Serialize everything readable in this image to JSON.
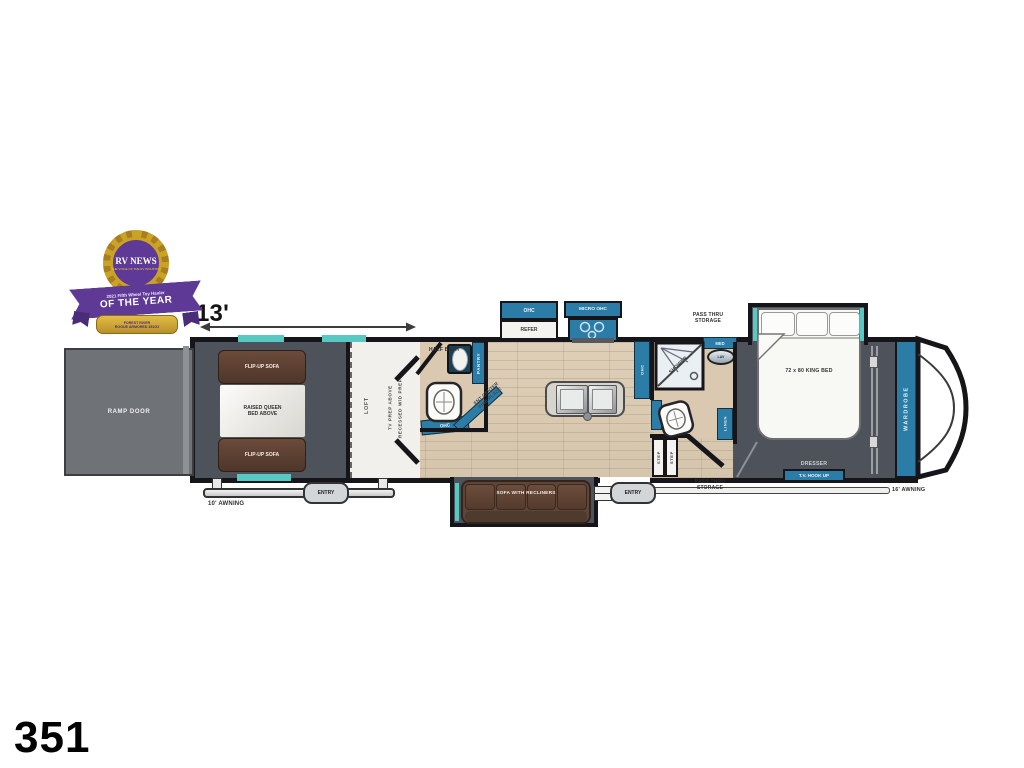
{
  "page": {
    "model_number": "351",
    "garage_dimension": "13'"
  },
  "badge": {
    "brand": "RV NEWS",
    "tagline": "THE VOICE OF THE RV INDUSTRY",
    "award_line1": "2021 Fifth Wheel Toy Hauler",
    "award_line2": "OF THE YEAR",
    "winner_line1": "FOREST RIVER",
    "winner_line2": "ROGUE ARMORED 351G2"
  },
  "floorplan": {
    "garage": {
      "ramp_door": "RAMP DOOR",
      "flip_up_sofa": "FLIP-UP SOFA",
      "raised_queen_line1": "RAISED QUEEN",
      "raised_queen_line2": "BED ABOVE",
      "entry": "ENTRY",
      "awning": "10' AWNING"
    },
    "loft": {
      "loft": "LOFT",
      "tv_prep": "TV PREP ABOVE",
      "wd_prep": "RECESSED W/D PREP"
    },
    "half_bath": {
      "title": "HALF BATH",
      "pantry": "PANTRY",
      "ohc": "OHC"
    },
    "kitchen": {
      "ohc": "OHC",
      "refer": "REFER",
      "micro_ohc": "MICRO OHC",
      "counter_ohc": "OHC",
      "ent_center_line1": "ENT CENTER",
      "ent_center_line2": "FIRE PLACE"
    },
    "living": {
      "sofa": "SOFA WITH RECLINERS",
      "entry": "ENTRY"
    },
    "bath": {
      "shower": "SHOWER",
      "med": "MED",
      "lav": "LAV",
      "linen": "LINEN",
      "step1": "STEP",
      "step2": "STEP",
      "pass_thru_line1": "PASS THRU",
      "pass_thru_line2": "STORAGE"
    },
    "bedroom": {
      "bed": "72 x 80 KING BED",
      "dresser": "DRESSER",
      "tv_hookup": "T.V.  HOOK UP",
      "wardrobe": "WARDROBE",
      "awning": "16' AWNING",
      "pass_thru_line1": "PASS THRU",
      "pass_thru_line2": "STORAGE"
    }
  },
  "colors": {
    "cabinet_blue": "#2b7ca7",
    "accent_teal": "#58c8c2",
    "interior_dark": "#4e525a",
    "wall_black": "#15151a",
    "sofa_brown": "#5e4537",
    "floor_wood": "#d9c9b2",
    "badge_purple": "#5e3a96",
    "badge_gold": "#c9a227"
  }
}
